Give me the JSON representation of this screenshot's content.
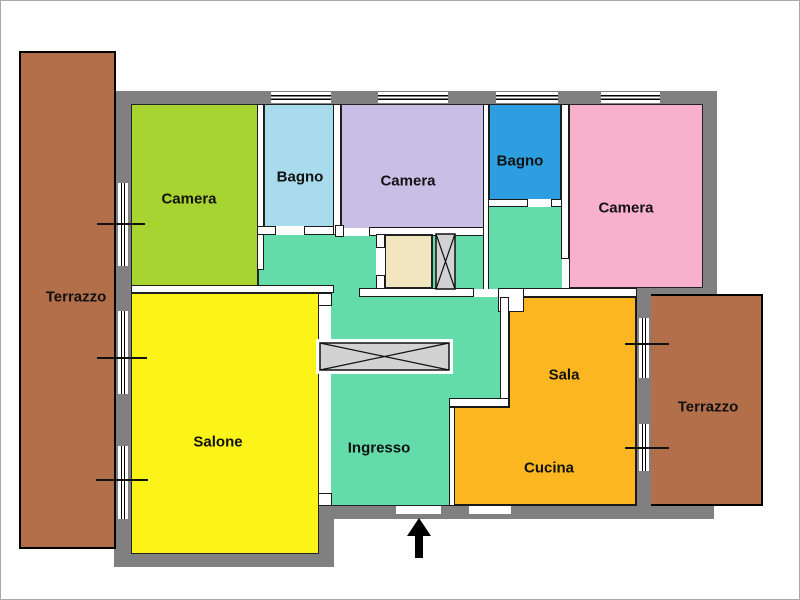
{
  "plan": {
    "wall_color": "#808080",
    "outline_color": "#1a1a1a",
    "hatch_fill": "#d2d2d2",
    "arrow_color": "#000000",
    "rooms": {
      "terrazzo_left": {
        "label": "Terrazzo",
        "color": "#b26f4a"
      },
      "camera_nw": {
        "label": "Camera",
        "color": "#a8d432"
      },
      "bagno_1": {
        "label": "Bagno",
        "color": "#a8dcec"
      },
      "camera_n": {
        "label": "Camera",
        "color": "#c9bfe6"
      },
      "bagno_2": {
        "label": "Bagno",
        "color": "#2d9fe0"
      },
      "camera_ne": {
        "label": "Camera",
        "color": "#f9b0ca"
      },
      "salone": {
        "label": "Salone",
        "color": "#fcf318"
      },
      "ingresso": {
        "label": "Ingresso",
        "color": "#63dcaa"
      },
      "sala": {
        "label": "Sala",
        "color": "#fcb61f"
      },
      "cucina": {
        "label": "Cucina",
        "color": "#fcb61f"
      },
      "terrazzo_right": {
        "label": "Terrazzo",
        "color": "#b26f4a"
      },
      "closet": {
        "color": "#f2e6c0"
      }
    }
  }
}
